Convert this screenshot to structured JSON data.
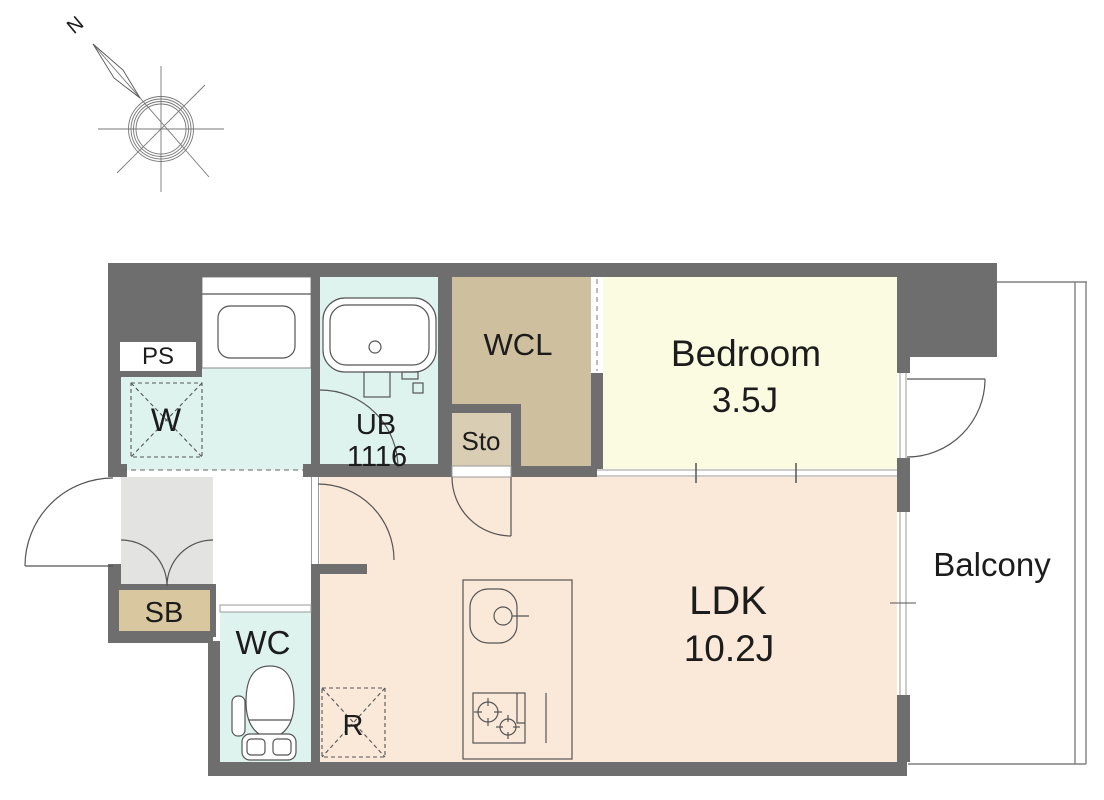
{
  "title": "Apartment floor plan",
  "compass": {
    "north_label": "N"
  },
  "rooms": {
    "ps": {
      "label": "PS"
    },
    "washer_space": {
      "label": "W"
    },
    "unit_bath": {
      "label": "UB",
      "size": "1116"
    },
    "walk_in_closet": {
      "label": "WCL"
    },
    "storage": {
      "label": "Sto"
    },
    "bedroom": {
      "label": "Bedroom",
      "size": "3.5J"
    },
    "shoe_box": {
      "label": "SB"
    },
    "toilet": {
      "label": "WC"
    },
    "ldk": {
      "label": "LDK",
      "size": "10.2J"
    },
    "refrigerator_space": {
      "label": "R"
    },
    "balcony": {
      "label": "Balcony"
    }
  },
  "colors": {
    "wall": "#6e6e6e",
    "wet_area_floor": "#def3ee",
    "closet_floor": "#cec09e",
    "storage_floor": "#d9cdb4",
    "bedroom_floor": "#fbfbe2",
    "ldk_floor": "#fae8d9",
    "shoe_box": "#d9c79f",
    "entrance_floor": "#e3e3e2",
    "line": "#555555"
  }
}
